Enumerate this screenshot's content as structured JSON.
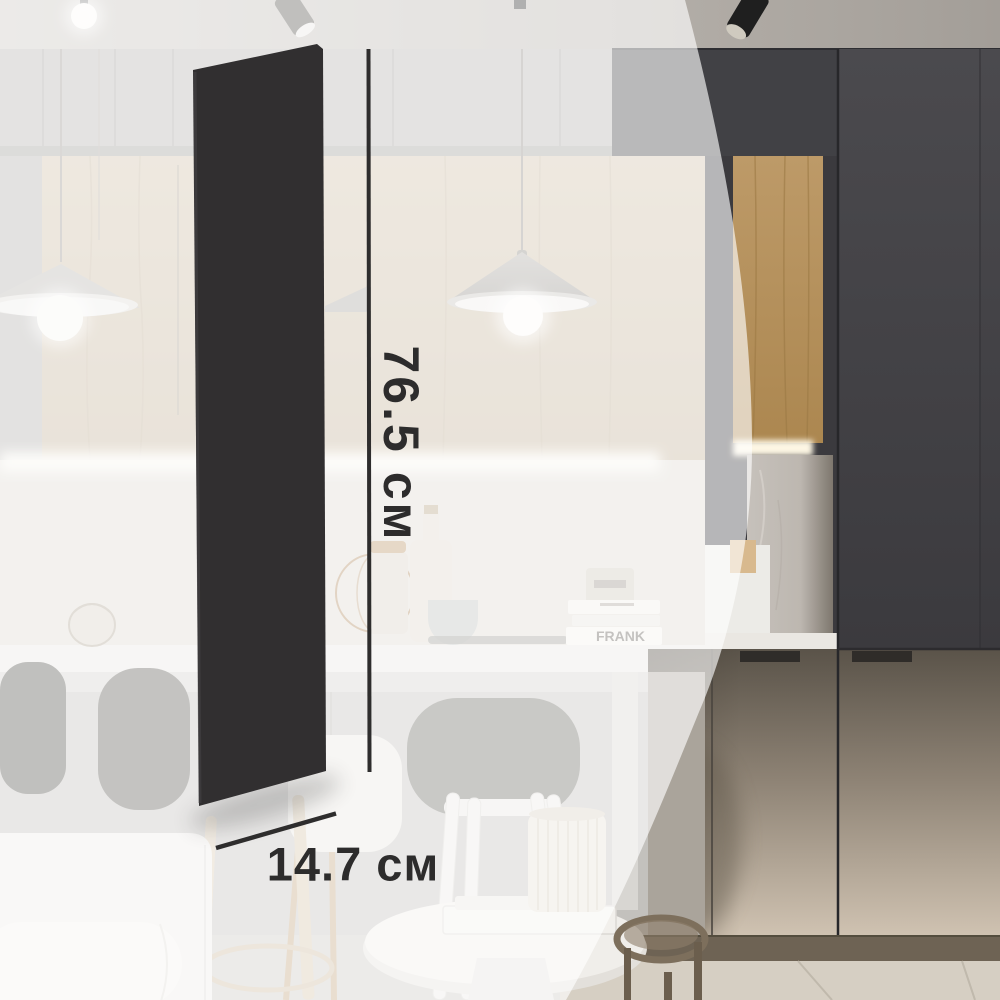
{
  "dimensions": {
    "height": {
      "value": "76.5 см"
    },
    "width": {
      "value": "14.7 см"
    }
  },
  "scene": {
    "book_spine_text": "FRANK",
    "colors": {
      "panel": "#312f30",
      "annotation": "#2e2d2d",
      "overlay": "#ffffff",
      "wood_wall": "#cdbda4",
      "wood_niche": "#b99562",
      "dark_cabinet": "#414145",
      "lower_doors": "#c9bcab",
      "plinth": "#6e6354",
      "floor": "#d6cfc3"
    }
  }
}
